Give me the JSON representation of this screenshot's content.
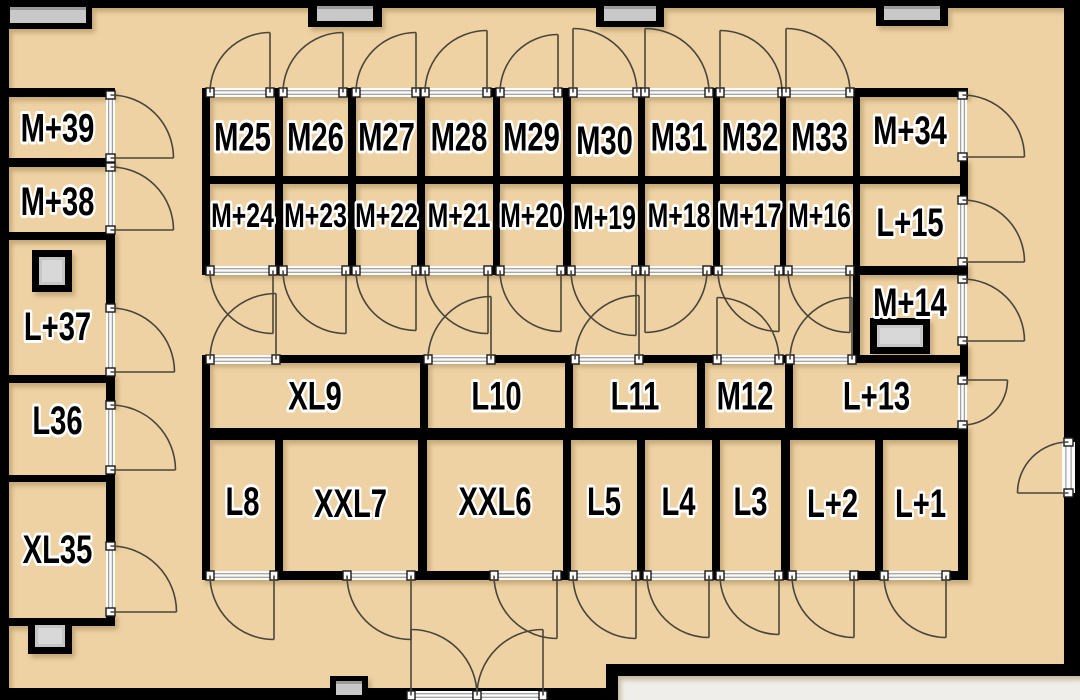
{
  "title": "Storage facility floor plan",
  "colors": {
    "floor": "#eed2a4",
    "wall": "#000000",
    "outside": "#f0eeea",
    "arc": "#4a453c",
    "threshold": "#fbfbfb",
    "threshold_line": "#8a8a8a",
    "threshold_block_edge": "#1a1a1a",
    "window_fill": "#c8c8c8",
    "window_edge": "#9a9a9a",
    "pillar_fill": "#c6c6c6",
    "pillar_inner": "#d8d8d8",
    "label": "#000000",
    "label_halo": "#ffffff",
    "wall_shadow": "#8a6b3a"
  },
  "canvas": {
    "width": 1080,
    "height": 700
  },
  "rooms": [
    {
      "id": "M25",
      "label": "M25",
      "x": 210,
      "y": 97,
      "w": 65,
      "h": 79,
      "size": "lg"
    },
    {
      "id": "M26",
      "label": "M26",
      "x": 283,
      "y": 97,
      "w": 65,
      "h": 79,
      "size": "lg"
    },
    {
      "id": "M27",
      "label": "M27",
      "x": 356,
      "y": 97,
      "w": 61,
      "h": 79,
      "size": "lg"
    },
    {
      "id": "M28",
      "label": "M28",
      "x": 425,
      "y": 97,
      "w": 68,
      "h": 79,
      "size": "lg"
    },
    {
      "id": "M29",
      "label": "M29",
      "x": 500,
      "y": 97,
      "w": 63,
      "h": 79,
      "size": "lg"
    },
    {
      "id": "M30",
      "label": "M30",
      "x": 571,
      "y": 97,
      "w": 67,
      "h": 79,
      "size": "lg",
      "ly": 140
    },
    {
      "id": "M31",
      "label": "M31",
      "x": 645,
      "y": 97,
      "w": 68,
      "h": 79,
      "size": "lg"
    },
    {
      "id": "M32",
      "label": "M32",
      "x": 720,
      "y": 97,
      "w": 60,
      "h": 79,
      "size": "lg"
    },
    {
      "id": "M33",
      "label": "M33",
      "x": 786,
      "y": 97,
      "w": 67,
      "h": 79,
      "size": "lg"
    },
    {
      "id": "M+34",
      "label": "M+34",
      "x": 860,
      "y": 97,
      "w": 100,
      "h": 79,
      "size": "lg",
      "ly": 130
    },
    {
      "id": "M+24",
      "label": "M+24",
      "x": 210,
      "y": 184,
      "w": 65,
      "h": 82,
      "size": "md",
      "ly": 215
    },
    {
      "id": "M+23",
      "label": "M+23",
      "x": 283,
      "y": 184,
      "w": 65,
      "h": 82,
      "size": "md",
      "ly": 215
    },
    {
      "id": "M+22",
      "label": "M+22",
      "x": 356,
      "y": 184,
      "w": 61,
      "h": 82,
      "size": "md",
      "ly": 215
    },
    {
      "id": "M+21",
      "label": "M+21",
      "x": 425,
      "y": 184,
      "w": 68,
      "h": 82,
      "size": "md",
      "ly": 215
    },
    {
      "id": "M+20",
      "label": "M+20",
      "x": 500,
      "y": 184,
      "w": 63,
      "h": 82,
      "size": "md",
      "ly": 215
    },
    {
      "id": "M+19",
      "label": "M+19",
      "x": 571,
      "y": 184,
      "w": 67,
      "h": 82,
      "size": "md",
      "ly": 217
    },
    {
      "id": "M+18",
      "label": "M+18",
      "x": 645,
      "y": 184,
      "w": 68,
      "h": 82,
      "size": "md",
      "ly": 215
    },
    {
      "id": "M+17",
      "label": "M+17",
      "x": 720,
      "y": 184,
      "w": 60,
      "h": 82,
      "size": "md",
      "ly": 215
    },
    {
      "id": "M+16",
      "label": "M+16",
      "x": 786,
      "y": 184,
      "w": 67,
      "h": 82,
      "size": "md",
      "ly": 215
    },
    {
      "id": "L+15",
      "label": "L+15",
      "x": 860,
      "y": 184,
      "w": 100,
      "h": 82,
      "size": "lg",
      "ly": 222
    },
    {
      "id": "M+14",
      "label": "M+14",
      "x": 860,
      "y": 275,
      "w": 100,
      "h": 80,
      "size": "lg",
      "ly": 302
    },
    {
      "id": "XL9",
      "label": "XL9",
      "x": 210,
      "y": 363,
      "w": 210,
      "h": 65,
      "size": "lg"
    },
    {
      "id": "L10",
      "label": "L10",
      "x": 428,
      "y": 363,
      "w": 137,
      "h": 65,
      "size": "lg"
    },
    {
      "id": "L11",
      "label": "L11",
      "x": 573,
      "y": 363,
      "w": 124,
      "h": 65,
      "size": "lg"
    },
    {
      "id": "M12",
      "label": "M12",
      "x": 705,
      "y": 363,
      "w": 80,
      "h": 65,
      "size": "lg"
    },
    {
      "id": "L+13",
      "label": "L+13",
      "x": 793,
      "y": 363,
      "w": 167,
      "h": 65,
      "size": "lg"
    },
    {
      "id": "L8",
      "label": "L8",
      "x": 210,
      "y": 440,
      "w": 65,
      "h": 131,
      "size": "lg",
      "ly": 501
    },
    {
      "id": "XXL7",
      "label": "XXL7",
      "x": 283,
      "y": 440,
      "w": 135,
      "h": 131,
      "size": "lg",
      "ly": 503
    },
    {
      "id": "XXL6",
      "label": "XXL6",
      "x": 427,
      "y": 440,
      "w": 136,
      "h": 131,
      "size": "lg",
      "ly": 501
    },
    {
      "id": "L5",
      "label": "L5",
      "x": 571,
      "y": 440,
      "w": 66,
      "h": 131,
      "size": "lg",
      "ly": 501
    },
    {
      "id": "L4",
      "label": "L4",
      "x": 645,
      "y": 440,
      "w": 67,
      "h": 131,
      "size": "lg",
      "ly": 501
    },
    {
      "id": "L3",
      "label": "L3",
      "x": 720,
      "y": 440,
      "w": 61,
      "h": 131,
      "size": "lg",
      "ly": 501
    },
    {
      "id": "L+2",
      "label": "L+2",
      "x": 790,
      "y": 440,
      "w": 85,
      "h": 131,
      "size": "lg",
      "ly": 503
    },
    {
      "id": "L+1",
      "label": "L+1",
      "x": 883,
      "y": 440,
      "w": 75,
      "h": 131,
      "size": "lg",
      "ly": 503
    },
    {
      "id": "M+39",
      "label": "M+39",
      "x": 9,
      "y": 97,
      "w": 97,
      "h": 61,
      "size": "lg"
    },
    {
      "id": "M+38",
      "label": "M+38",
      "x": 9,
      "y": 167,
      "w": 97,
      "h": 63,
      "size": "lg",
      "ly": 201
    },
    {
      "id": "L+37",
      "label": "L+37",
      "x": 9,
      "y": 240,
      "w": 97,
      "h": 135,
      "size": "lg",
      "ly": 326
    },
    {
      "id": "L36",
      "label": "L36",
      "x": 9,
      "y": 383,
      "w": 97,
      "h": 92,
      "size": "lg",
      "ly": 420
    },
    {
      "id": "XL35",
      "label": "XL35",
      "x": 9,
      "y": 481,
      "w": 97,
      "h": 137,
      "size": "lg",
      "ly": 549
    }
  ],
  "walls": [
    [
      0,
      0,
      1080,
      8
    ],
    [
      0,
      0,
      9,
      700
    ],
    [
      1064,
      0,
      16,
      672
    ],
    [
      0,
      688,
      618,
      12
    ],
    [
      606,
      664,
      12,
      36
    ],
    [
      606,
      664,
      474,
      12
    ],
    [
      9,
      88,
      106,
      9
    ],
    [
      106,
      88,
      9,
      8
    ],
    [
      9,
      158,
      106,
      9
    ],
    [
      9,
      232,
      106,
      8
    ],
    [
      106,
      230,
      9,
      78
    ],
    [
      9,
      375,
      106,
      8
    ],
    [
      106,
      372,
      9,
      34
    ],
    [
      9,
      475,
      106,
      7
    ],
    [
      106,
      470,
      9,
      77
    ],
    [
      9,
      618,
      106,
      8
    ],
    [
      106,
      612,
      9,
      14
    ],
    [
      202,
      88,
      766,
      9
    ],
    [
      202,
      88,
      8,
      187
    ],
    [
      202,
      176,
      766,
      8
    ],
    [
      202,
      266,
      766,
      9
    ],
    [
      275,
      88,
      8,
      187
    ],
    [
      348,
      88,
      8,
      187
    ],
    [
      417,
      88,
      8,
      187
    ],
    [
      493,
      88,
      7,
      187
    ],
    [
      563,
      88,
      8,
      187
    ],
    [
      638,
      88,
      7,
      187
    ],
    [
      713,
      88,
      7,
      187
    ],
    [
      780,
      88,
      6,
      187
    ],
    [
      853,
      88,
      7,
      187
    ],
    [
      960,
      88,
      8,
      7
    ],
    [
      960,
      158,
      8,
      42
    ],
    [
      960,
      262,
      8,
      17
    ],
    [
      960,
      343,
      8,
      37
    ],
    [
      960,
      424,
      8,
      14
    ],
    [
      853,
      275,
      7,
      88
    ],
    [
      202,
      355,
      766,
      8
    ],
    [
      202,
      355,
      8,
      87
    ],
    [
      420,
      363,
      8,
      67
    ],
    [
      565,
      363,
      8,
      67
    ],
    [
      697,
      363,
      8,
      67
    ],
    [
      785,
      363,
      8,
      67
    ],
    [
      202,
      428,
      766,
      12
    ],
    [
      202,
      440,
      8,
      140
    ],
    [
      275,
      440,
      8,
      140
    ],
    [
      418,
      440,
      9,
      140
    ],
    [
      563,
      440,
      8,
      140
    ],
    [
      637,
      440,
      8,
      140
    ],
    [
      712,
      440,
      8,
      140
    ],
    [
      781,
      440,
      9,
      140
    ],
    [
      875,
      440,
      8,
      140
    ],
    [
      958,
      436,
      10,
      144
    ],
    [
      202,
      571,
      766,
      9
    ]
  ],
  "outside_areas": [
    [
      618,
      676,
      462,
      24
    ]
  ],
  "windows": [
    {
      "name": "window-top-1",
      "frame": [
        0,
        0,
        92,
        29
      ],
      "fill": [
        10,
        7,
        76,
        16
      ]
    },
    {
      "name": "window-top-2",
      "frame": [
        308,
        0,
        74,
        27
      ],
      "fill": [
        317,
        6,
        56,
        15
      ]
    },
    {
      "name": "window-top-3",
      "frame": [
        596,
        0,
        68,
        27
      ],
      "fill": [
        604,
        6,
        52,
        15
      ]
    },
    {
      "name": "window-top-4",
      "frame": [
        876,
        0,
        72,
        26
      ],
      "fill": [
        884,
        6,
        56,
        14
      ]
    },
    {
      "name": "window-bottom-1",
      "frame": [
        330,
        676,
        38,
        24
      ],
      "fill": [
        336,
        681,
        26,
        14
      ]
    }
  ],
  "pillars": [
    {
      "name": "pillar-L37",
      "frame": [
        32,
        250,
        40,
        42
      ],
      "fill": [
        39,
        257,
        26,
        28
      ]
    },
    {
      "name": "pillar-XL35",
      "frame": [
        28,
        618,
        44,
        36
      ],
      "fill": [
        35,
        625,
        30,
        22
      ]
    },
    {
      "name": "pillar-M14",
      "frame": [
        870,
        318,
        60,
        36
      ],
      "fill": [
        877,
        325,
        46,
        22
      ]
    }
  ],
  "doors": [
    {
      "id": "door-M25",
      "x": 210,
      "y": 88,
      "len": 60,
      "o": "up",
      "h": "far"
    },
    {
      "id": "door-M26",
      "x": 283,
      "y": 88,
      "len": 60,
      "o": "up",
      "h": "far"
    },
    {
      "id": "door-M27",
      "x": 356,
      "y": 88,
      "len": 60,
      "o": "up",
      "h": "far"
    },
    {
      "id": "door-M28",
      "x": 425,
      "y": 88,
      "len": 62,
      "o": "up",
      "h": "far"
    },
    {
      "id": "door-M29",
      "x": 500,
      "y": 88,
      "len": 58,
      "o": "up",
      "h": "far"
    },
    {
      "id": "door-M30",
      "x": 573,
      "y": 88,
      "len": 64,
      "o": "up",
      "h": "near"
    },
    {
      "id": "door-M31",
      "x": 645,
      "y": 88,
      "len": 64,
      "o": "up",
      "h": "near"
    },
    {
      "id": "door-M32",
      "x": 720,
      "y": 88,
      "len": 62,
      "o": "up",
      "h": "near"
    },
    {
      "id": "door-M33",
      "x": 786,
      "y": 88,
      "len": 64,
      "o": "up",
      "h": "near"
    },
    {
      "id": "door-M+34",
      "x": 958,
      "y": 95,
      "len": 62,
      "o": "right",
      "h": "far"
    },
    {
      "id": "door-M+24",
      "x": 210,
      "y": 266,
      "len": 63,
      "o": "down",
      "h": "far"
    },
    {
      "id": "door-M+23",
      "x": 283,
      "y": 266,
      "len": 63,
      "o": "down",
      "h": "far"
    },
    {
      "id": "door-M+22",
      "x": 356,
      "y": 266,
      "len": 60,
      "o": "down",
      "h": "far"
    },
    {
      "id": "door-M+21",
      "x": 425,
      "y": 266,
      "len": 63,
      "o": "down",
      "h": "far"
    },
    {
      "id": "door-M+20",
      "x": 500,
      "y": 266,
      "len": 61,
      "o": "down",
      "h": "far"
    },
    {
      "id": "door-M+19",
      "x": 571,
      "y": 266,
      "len": 65,
      "o": "down",
      "h": "far"
    },
    {
      "id": "door-M+18",
      "x": 645,
      "y": 266,
      "len": 62,
      "o": "down",
      "h": "near"
    },
    {
      "id": "door-M+17",
      "x": 718,
      "y": 266,
      "len": 61,
      "o": "down",
      "h": "far"
    },
    {
      "id": "door-M+16",
      "x": 788,
      "y": 266,
      "len": 62,
      "o": "down",
      "h": "far"
    },
    {
      "id": "door-L+15",
      "x": 958,
      "y": 200,
      "len": 62,
      "o": "right",
      "h": "far"
    },
    {
      "id": "door-M+14",
      "x": 958,
      "y": 279,
      "len": 62,
      "o": "right",
      "h": "far"
    },
    {
      "id": "door-XL9",
      "x": 210,
      "y": 355,
      "len": 66,
      "o": "up",
      "h": "far"
    },
    {
      "id": "door-L10",
      "x": 428,
      "y": 355,
      "len": 63,
      "o": "up",
      "h": "far"
    },
    {
      "id": "door-L11",
      "x": 575,
      "y": 355,
      "len": 64,
      "o": "up",
      "h": "far"
    },
    {
      "id": "door-M12",
      "x": 717,
      "y": 355,
      "len": 62,
      "o": "up",
      "h": "near"
    },
    {
      "id": "door-L+13-top",
      "x": 790,
      "y": 355,
      "len": 62,
      "o": "up",
      "h": "far"
    },
    {
      "id": "door-L+13-right",
      "x": 958,
      "y": 380,
      "len": 45,
      "o": "right",
      "h": "near"
    },
    {
      "id": "door-L8",
      "x": 210,
      "y": 571,
      "len": 64,
      "o": "down",
      "h": "far"
    },
    {
      "id": "door-XXL7",
      "x": 347,
      "y": 571,
      "len": 64,
      "o": "down",
      "h": "far"
    },
    {
      "id": "door-XXL6",
      "x": 494,
      "y": 571,
      "len": 63,
      "o": "down",
      "h": "far"
    },
    {
      "id": "door-L5",
      "x": 573,
      "y": 571,
      "len": 63,
      "o": "down",
      "h": "far"
    },
    {
      "id": "door-L4",
      "x": 647,
      "y": 571,
      "len": 62,
      "o": "down",
      "h": "far"
    },
    {
      "id": "door-L3",
      "x": 720,
      "y": 571,
      "len": 59,
      "o": "down",
      "h": "far"
    },
    {
      "id": "door-L+2",
      "x": 792,
      "y": 571,
      "len": 62,
      "o": "down",
      "h": "far"
    },
    {
      "id": "door-L+1",
      "x": 884,
      "y": 571,
      "len": 62,
      "o": "down",
      "h": "far"
    },
    {
      "id": "door-M+39",
      "x": 106,
      "y": 95,
      "len": 63,
      "o": "right",
      "h": "far"
    },
    {
      "id": "door-M+38",
      "x": 106,
      "y": 167,
      "len": 63,
      "o": "right",
      "h": "far"
    },
    {
      "id": "door-L+37",
      "x": 106,
      "y": 308,
      "len": 64,
      "o": "right",
      "h": "far"
    },
    {
      "id": "door-L36",
      "x": 106,
      "y": 405,
      "len": 65,
      "o": "right",
      "h": "far"
    },
    {
      "id": "door-XL35",
      "x": 106,
      "y": 546,
      "len": 66,
      "o": "right",
      "h": "far"
    },
    {
      "id": "door-side-entrance",
      "x": 1062,
      "y": 442,
      "len": 51,
      "w": 13,
      "o": "left",
      "h": "far"
    },
    {
      "id": "door-main-entrance-left",
      "x": 411,
      "y": 691,
      "len": 66,
      "o": "up",
      "h": "near"
    },
    {
      "id": "door-main-entrance-right",
      "x": 477,
      "y": 691,
      "len": 66,
      "o": "up",
      "h": "far"
    }
  ],
  "label_sizes": {
    "lg": 40,
    "md": 34
  }
}
